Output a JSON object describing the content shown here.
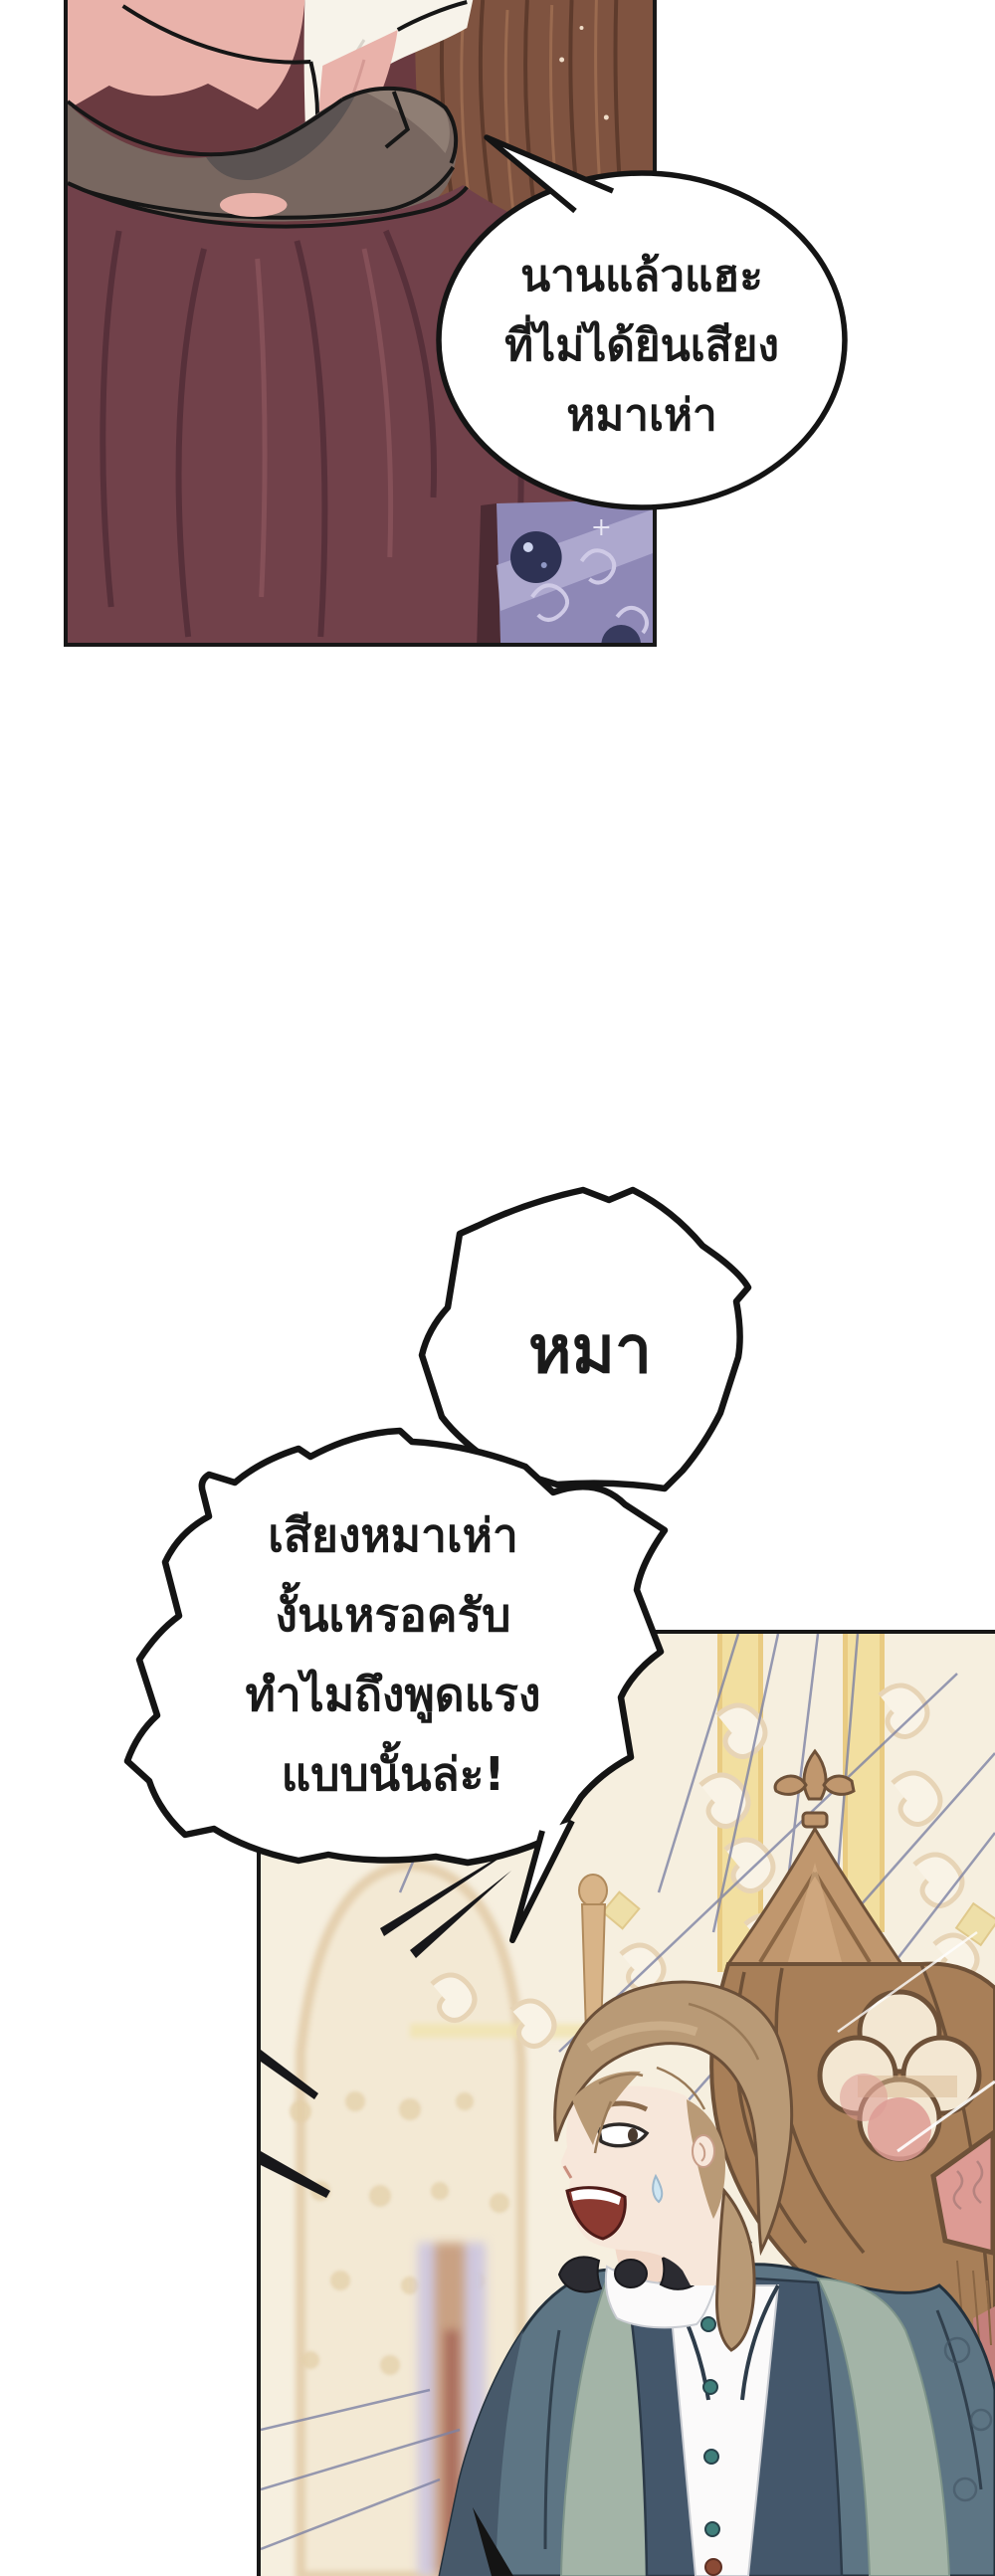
{
  "comic": {
    "page_label": "webtoon-comic-page",
    "speech_bubbles": {
      "top": {
        "lines": [
          "นานแล้วแฮะ",
          "ที่ไม่ได้ยินเสียง",
          "หมาเห่า"
        ]
      },
      "shout": {
        "text": "หมา"
      },
      "reply": {
        "lines": [
          "เสียงหมาเห่า",
          "งั้นเหรอครับ",
          "ทำไมถึงพูดแรง",
          "แบบนั้นล่ะ!"
        ]
      }
    },
    "panels": {
      "top_label": "figure-in-burgundy-cloak-with-fur-and-grey-collar",
      "bottom_label": "shouting-brown-haired-man-in-teal-coat-beside-gothic-chair"
    }
  },
  "colors": {
    "outline": "#171717",
    "bubble_fill": "#ffffff",
    "bubble_stroke": "#141414",
    "skin_top": "#e9b2aa",
    "white_cloth": "#f7f3ea",
    "collar_grey": "#786760",
    "cloak": "#71414a",
    "cloak_dark": "#57303a",
    "fur": "#7f5340",
    "ornament_purple": "#8e88b6",
    "orb_navy": "#2e3254",
    "cream_bg": "#f6efdf",
    "gold_band": "#f2dfa0",
    "speed_line": "#7d82a4",
    "chair_wood": "#c0976e",
    "chair_mid": "#a87f58",
    "red_panel": "#dd9b94",
    "hair": "#b99a76",
    "skin_man": "#f7e7da",
    "mouth": "#8c3a31",
    "sweat": "#cfe6f2",
    "coat": "#5d7584",
    "lapel": "#a3b4a7",
    "vest": "#44576b",
    "shirt": "#fbfafa",
    "button_teal": "#3f7e7a",
    "bowtie": "#2b2b31",
    "pillar_lavender": "#cfc8de"
  }
}
